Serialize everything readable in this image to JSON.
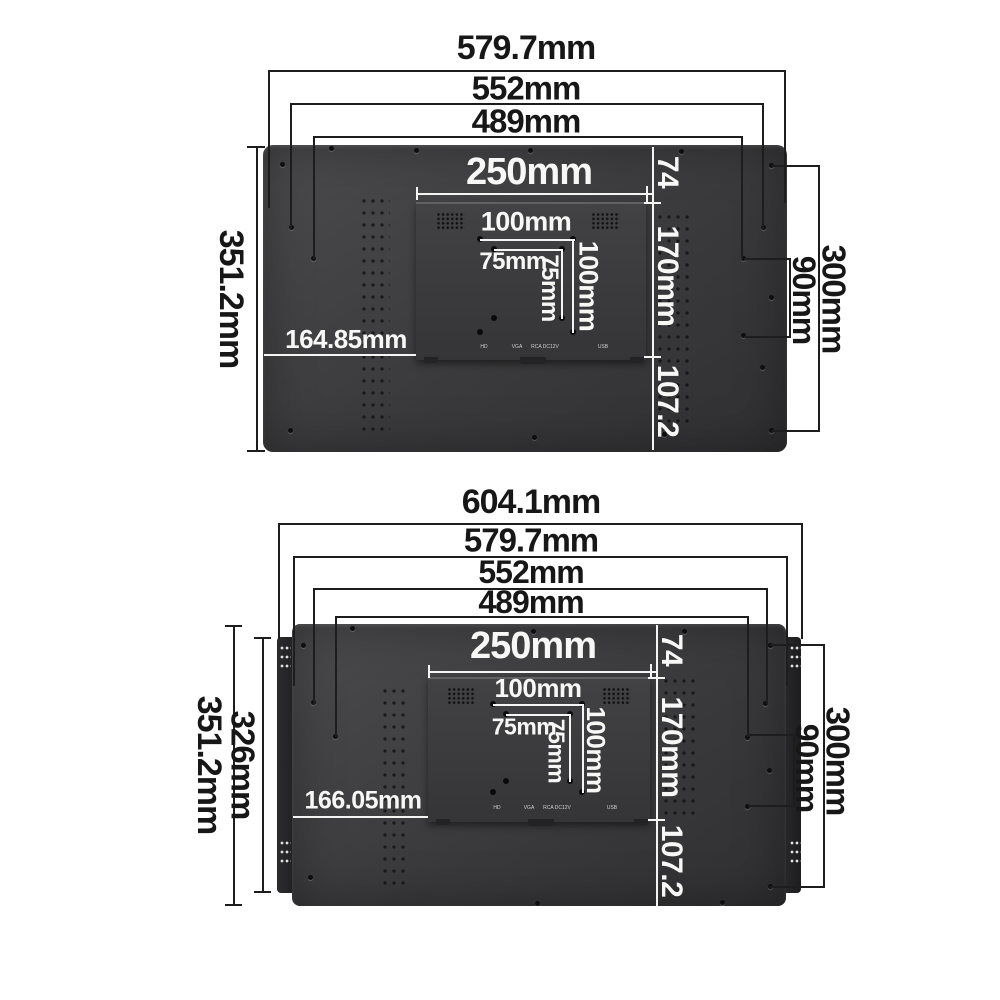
{
  "top": {
    "width_outer": "579.7mm",
    "width_holes_outer": "552mm",
    "width_holes_inner": "489mm",
    "height": "351.2mm",
    "plate_width": "250mm",
    "vesa100_width": "100mm",
    "vesa75_width": "75mm",
    "vesa75_height": "75mm",
    "vesa100_height": "100mm",
    "bottom_offset": "164.85mm",
    "top_segment": "74",
    "plate_segment": "170mm",
    "bottom_segment": "107.2",
    "right_span": "300mm",
    "right_gap": "90mm",
    "ports": [
      "HD",
      "VGA",
      "RCA DC12V",
      "USB"
    ]
  },
  "bottom": {
    "width_bracket": "604.1mm",
    "width_outer": "579.7mm",
    "width_holes_outer": "552mm",
    "width_holes_inner": "489mm",
    "height": "351.2mm",
    "bracket_height": "326mm",
    "plate_width": "250mm",
    "vesa100_width": "100mm",
    "vesa75_width": "75mm",
    "vesa75_height": "75mm",
    "vesa100_height": "100mm",
    "bottom_offset": "166.05mm",
    "top_segment": "74",
    "plate_segment": "170mm",
    "bottom_segment": "107.2",
    "right_span": "300mm",
    "right_gap": "90mm",
    "ports": [
      "HD",
      "VGA",
      "RCA DC12V",
      "USB"
    ]
  },
  "colors": {
    "panel": "#3a3a3c",
    "bracket": "#232325",
    "dim_line": "#1d1d1d",
    "white_line": "#f4f4f3",
    "background": "#ffffff"
  }
}
